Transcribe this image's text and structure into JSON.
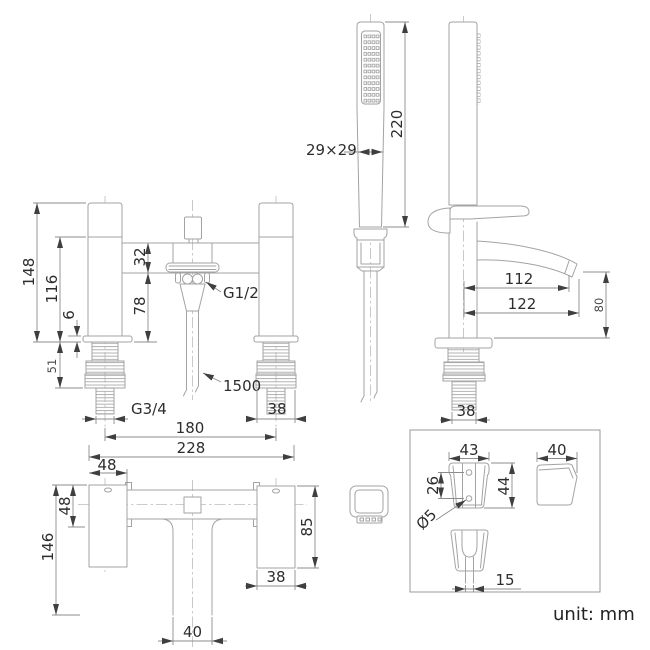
{
  "sheet": {
    "unit_label": "unit: mm"
  },
  "handset": {
    "length": "220",
    "head_size": "29×29"
  },
  "front": {
    "overall_height": "148",
    "body_height": "116",
    "deck_thickness": "6",
    "shank_length": "51",
    "top_offset": "32",
    "spout_clearance": "78",
    "outlet_thread": "G1/2",
    "hose_length": "1500",
    "inlet_thread": "G3/4",
    "shank_width": "38",
    "inlet_centres": "180",
    "overall_width": "228"
  },
  "side": {
    "spout_reach": "112",
    "overall_reach": "122",
    "spout_height": "80",
    "shank_width": "38"
  },
  "top": {
    "handle_width": "48",
    "handle_depth": "48",
    "overall_depth": "146",
    "body_depth": "85",
    "body_width": "38",
    "spout_width": "40"
  },
  "bracket": {
    "width": "43",
    "hole_spacing": "26",
    "height": "44",
    "hole_diameter": "Ø5",
    "depth": "40",
    "clip_opening": "15"
  }
}
